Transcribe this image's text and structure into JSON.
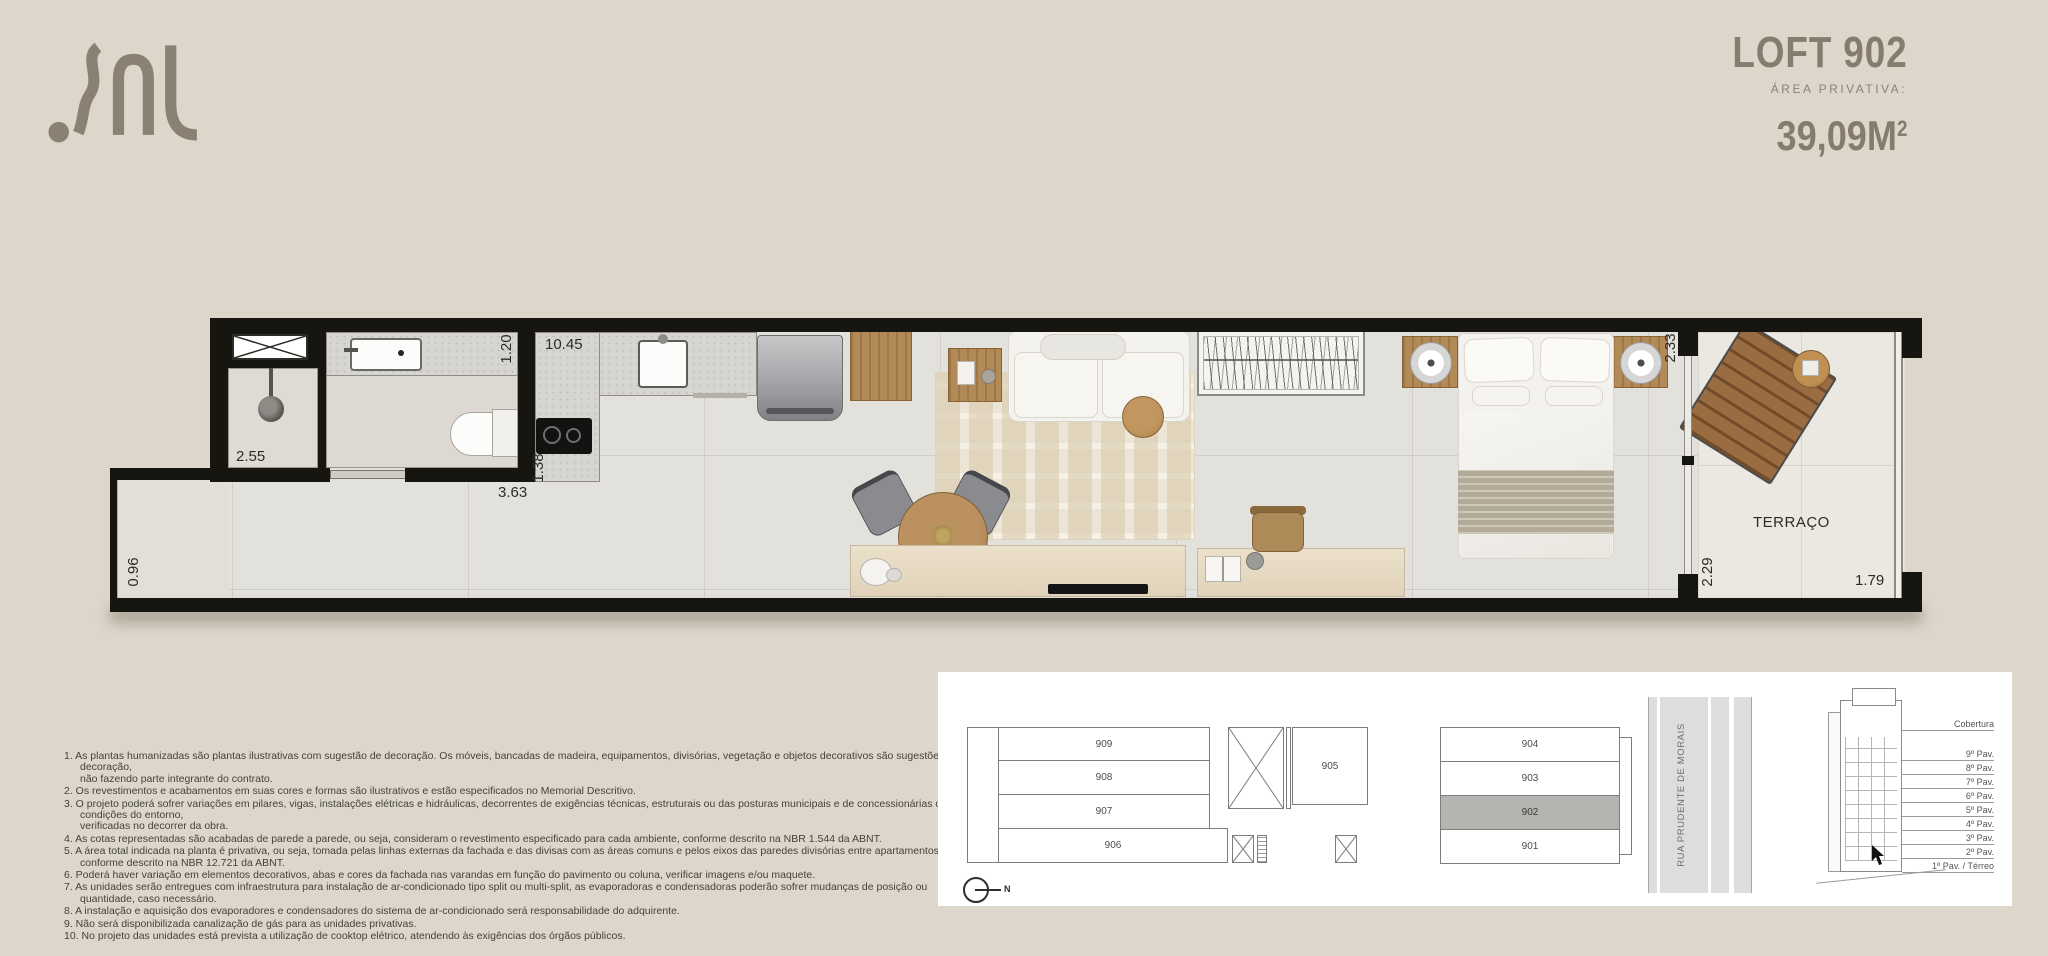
{
  "page": {
    "background": "#dcd7ca",
    "accent_text": "#857c6e"
  },
  "brand": {
    "name": "SAL"
  },
  "header": {
    "title": "LOFT 902",
    "area_label": "ÁREA PRIVATIVA:",
    "area_value": "39,09M",
    "area_superscript": "2"
  },
  "plan": {
    "labels": {
      "terrace": "TERRAÇO"
    },
    "dims": {
      "shower": "2.55",
      "bath_width": "1.20",
      "kitchen_length": "10.45",
      "kitchen_depth": "1.38",
      "bath_length": "3.63",
      "hall_width": "0.96",
      "bedroom_width": "2.33",
      "terrace_width": "2.29",
      "terrace_depth": "1.79"
    }
  },
  "notes": [
    "1. As plantas humanizadas são plantas ilustrativas com sugestão de decoração. Os móveis, bancadas de madeira, equipamentos, divisórias, vegetação e objetos decorativos são sugestões de decoração,\nnão fazendo parte integrante do contrato.",
    "2. Os revestimentos e acabamentos em suas cores e formas são ilustrativos e estão especificados no Memorial Descritivo.",
    "3. O projeto poderá sofrer variações em pilares, vigas, instalações elétricas e hidráulicas, decorrentes de exigências técnicas, estruturais ou das posturas municipais e de concessionárias ou de condições do entorno,\nverificadas no decorrer da obra.",
    "4. As cotas representadas são acabadas de parede a parede, ou seja, consideram o revestimento especificado para cada ambiente, conforme descrito na NBR 1.544 da ABNT.",
    "5. A área total indicada na planta é privativa, ou seja, tomada pelas linhas externas da fachada e das divisas com as áreas comuns e pelos eixos das paredes divisórias entre apartamentos, conforme descrito na NBR 12.721 da ABNT.",
    "6. Poderá haver variação em elementos decorativos, abas e cores da fachada nas varandas em função do pavimento ou coluna, verificar imagens e/ou maquete.",
    "7. As unidades serão entregues com infraestrutura para instalação de ar-condicionado tipo split ou multi-split, as evaporadoras e condensadoras poderão sofrer mudanças de posição ou quantidade, caso necessário.",
    "8. A instalação e aquisição dos evaporadores e condensadores do sistema de ar-condicionado será responsabilidade do adquirente.",
    "9. Não será disponibilizada canalização de gás para as unidades privativas.",
    "10. No projeto das unidades está prevista a utilização de cooktop elétrico, atendendo às exigências dos órgãos públicos."
  ],
  "key_plan": {
    "units": {
      "u909": "909",
      "u908": "908",
      "u907": "907",
      "u906": "906",
      "u905": "905",
      "u904": "904",
      "u903": "903",
      "u902": "902",
      "u901": "901"
    },
    "highlighted_unit": "902",
    "highlight_color": "#b5b4b1",
    "street": "RUA PRUDENTE DE MORAIS",
    "north_label": "N",
    "elevation": {
      "floors": [
        "Cobertura",
        "9º Pav.",
        "8º Pav.",
        "7º Pav.",
        "6º Pav.",
        "5º Pav.",
        "4º Pav.",
        "3º Pav.",
        "2º Pav.",
        "1º Pav. / Térreo"
      ]
    }
  }
}
